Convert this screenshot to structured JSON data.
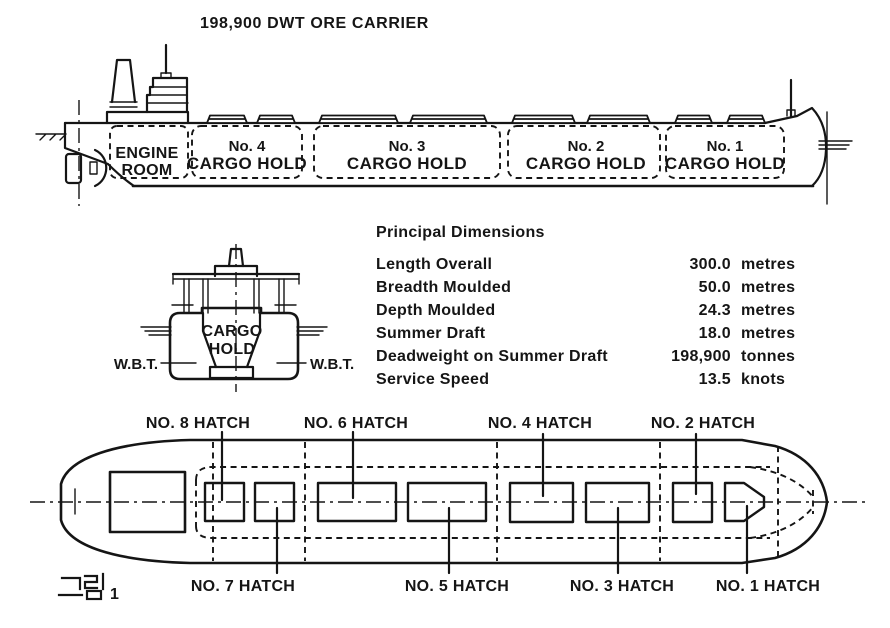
{
  "colors": {
    "ink": "#151515",
    "paper": "#ffffff"
  },
  "title": "198,900 DWT ORE CARRIER",
  "side_view": {
    "engine_room": [
      "ENGINE",
      "ROOM"
    ],
    "holds": [
      {
        "number": "No. 4",
        "name": "CARGO HOLD"
      },
      {
        "number": "No. 3",
        "name": "CARGO HOLD"
      },
      {
        "number": "No. 2",
        "name": "CARGO HOLD"
      },
      {
        "number": "No. 1",
        "name": "CARGO HOLD"
      }
    ]
  },
  "section_view": {
    "hold": [
      "CARGO",
      "HOLD"
    ],
    "wbt_left": "W.B.T.",
    "wbt_right": "W.B.T."
  },
  "dimensions": {
    "heading": "Principal Dimensions",
    "rows": [
      {
        "label": "Length Overall",
        "value": "300.0",
        "unit": "metres"
      },
      {
        "label": "Breadth Moulded",
        "value": "50.0",
        "unit": "metres"
      },
      {
        "label": "Depth Moulded",
        "value": "24.3",
        "unit": "metres"
      },
      {
        "label": "Summer Draft",
        "value": "18.0",
        "unit": "metres"
      },
      {
        "label": "Deadweight on Summer Draft",
        "value": "198,900",
        "unit": "tonnes"
      },
      {
        "label": "Service Speed",
        "value": "13.5",
        "unit": "knots"
      }
    ]
  },
  "plan_view": {
    "top_labels": [
      "NO. 8 HATCH",
      "NO. 6 HATCH",
      "NO. 4 HATCH",
      "NO. 2 HATCH"
    ],
    "bottom_labels": [
      "NO. 7 HATCH",
      "NO. 5 HATCH",
      "NO. 3 HATCH",
      "NO. 1 HATCH"
    ],
    "figure_label": "그림 1",
    "figure_number": "1"
  }
}
